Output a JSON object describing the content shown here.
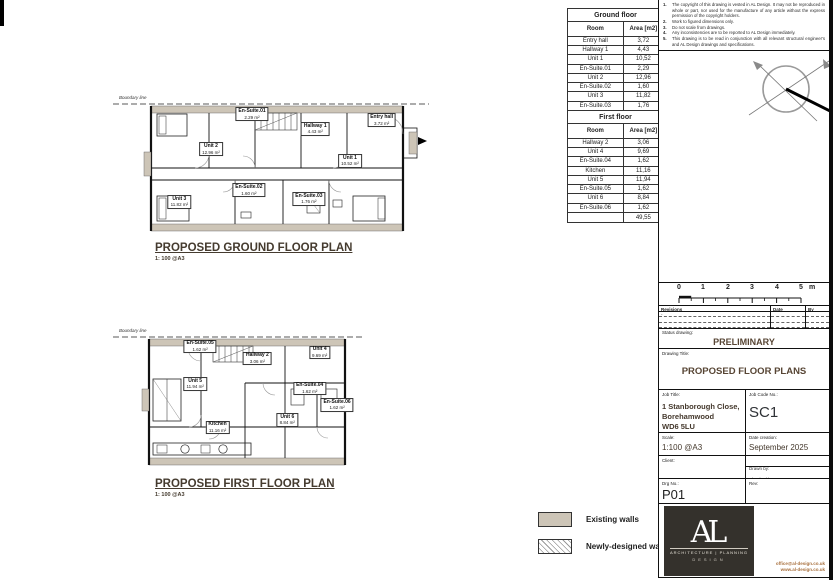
{
  "sheet": {
    "notes": [
      {
        "n": "1.",
        "t": "The copyright of this drawing is vested in AL Design. It may not be reproduced in whole or part, nor used for the manufacture of any article without the express permission of the copyright holders."
      },
      {
        "n": "2.",
        "t": "Work to figured dimensions only."
      },
      {
        "n": "3.",
        "t": "Do not scale from drawings."
      },
      {
        "n": "4.",
        "t": "Any inconsistencies are to be reported to AL Design immediately."
      },
      {
        "n": "5.",
        "t": "This drawing is to be read in conjunction with all relevant structural engineer's and AL Design drawings and specifications."
      }
    ]
  },
  "tables": {
    "ground": {
      "title": "Ground floor",
      "columns": [
        "Room",
        "Area [m2]"
      ],
      "rows": [
        [
          "Entry hall",
          "3,72"
        ],
        [
          "Hallway 1",
          "4,43"
        ],
        [
          "Unit 1",
          "10,52"
        ],
        [
          "En-Suite.01",
          "2,29"
        ],
        [
          "Unit 2",
          "12,96"
        ],
        [
          "En-Suite.02",
          "1,60"
        ],
        [
          "Unit 3",
          "11,82"
        ],
        [
          "En-Suite.03",
          "1,76"
        ]
      ],
      "total": "49,10"
    },
    "first": {
      "title": "First floor",
      "columns": [
        "Room",
        "Area [m2]"
      ],
      "rows": [
        [
          "Hallway 2",
          "3,06"
        ],
        [
          "Unit 4",
          "9,69"
        ],
        [
          "En-Suite.04",
          "1,62"
        ],
        [
          "Kitchen",
          "11,16"
        ],
        [
          "Unit 5",
          "11,94"
        ],
        [
          "En-Suite.05",
          "1,62"
        ],
        [
          "Unit 6",
          "8,84"
        ],
        [
          "En-Suite.06",
          "1,62"
        ]
      ],
      "total": "49,55"
    }
  },
  "plans": {
    "ground": {
      "title": "PROPOSED GROUND FLOOR PLAN",
      "scale_note": "1: 100 @A3",
      "boundary": "Boundary line",
      "rooms": [
        {
          "name": "Unit 2",
          "area": "12.96 m²"
        },
        {
          "name": "Hallway 1",
          "area": "4.43 m²"
        },
        {
          "name": "Entry hall",
          "area": "3.72 m²"
        },
        {
          "name": "Unit 1",
          "area": "10.52 m²"
        },
        {
          "name": "En-Suite.01",
          "area": "2.29 m²"
        },
        {
          "name": "Unit 3",
          "area": "11.82 m²"
        },
        {
          "name": "En-Suite.02",
          "area": "1.60 m²"
        },
        {
          "name": "En-Suite.03",
          "area": "1.76 m²"
        }
      ]
    },
    "first": {
      "title": "PROPOSED FIRST FLOOR PLAN",
      "scale_note": "1: 100 @A3",
      "boundary": "Boundary line",
      "rooms": [
        {
          "name": "Unit 5",
          "area": "11.94 m²"
        },
        {
          "name": "Hallway 2",
          "area": "3.06 m²"
        },
        {
          "name": "Unit 4",
          "area": "9.69 m²"
        },
        {
          "name": "En-Suite.04",
          "area": "1.62 m²"
        },
        {
          "name": "Unit 6",
          "area": "8.84 m²"
        },
        {
          "name": "Kitchen",
          "area": "11.16 m²"
        },
        {
          "name": "En-Suite.05",
          "area": "1.62 m²"
        },
        {
          "name": "En-Suite.06",
          "area": "1.62 m²"
        }
      ]
    }
  },
  "scalebar": {
    "ticks": [
      "0",
      "1",
      "2",
      "3",
      "4",
      "5"
    ],
    "unit": "m"
  },
  "revisions": {
    "col_rev": "Revisions",
    "col_date": "Date",
    "col_by": "By",
    "row1": "-"
  },
  "status": {
    "label": "Status drawing:",
    "value": "PRELIMINARY"
  },
  "drawing": {
    "label": "Drawing Title:",
    "value": "PROPOSED FLOOR PLANS"
  },
  "job": {
    "label": "Job Title:",
    "line1": "1 Stanborough Close,",
    "line2": "Borehamwood",
    "line3": "WD6 5LU",
    "code_label": "Job Code No.:",
    "code": "SC1"
  },
  "meta": {
    "scale_label": "Scale:",
    "scale": "1:100 @A3",
    "date_label": "Date creation:",
    "date": "September 2025",
    "client_label": "Client:",
    "drawn_label": "Drawn by:",
    "drawn": "JM",
    "checked_label": "Checked by:",
    "checked": "AL",
    "drg_label": "Drg No.:",
    "drg": "P01",
    "rev_label": "Rev:"
  },
  "legend": {
    "existing": "Existing walls",
    "newly": "Newly-designed walls"
  },
  "logo": {
    "monogram": "AL",
    "line1": "ARCHITECTURE | PLANNING",
    "line2": "DESIGN",
    "contact1": "office@al-design.co.uk",
    "contact2": "www.al-design.co.uk"
  },
  "colors": {
    "existing_wall": "#cdc5b7",
    "heading": "#453b2f",
    "logo_bg": "#34312c",
    "contact": "#a9713f"
  }
}
